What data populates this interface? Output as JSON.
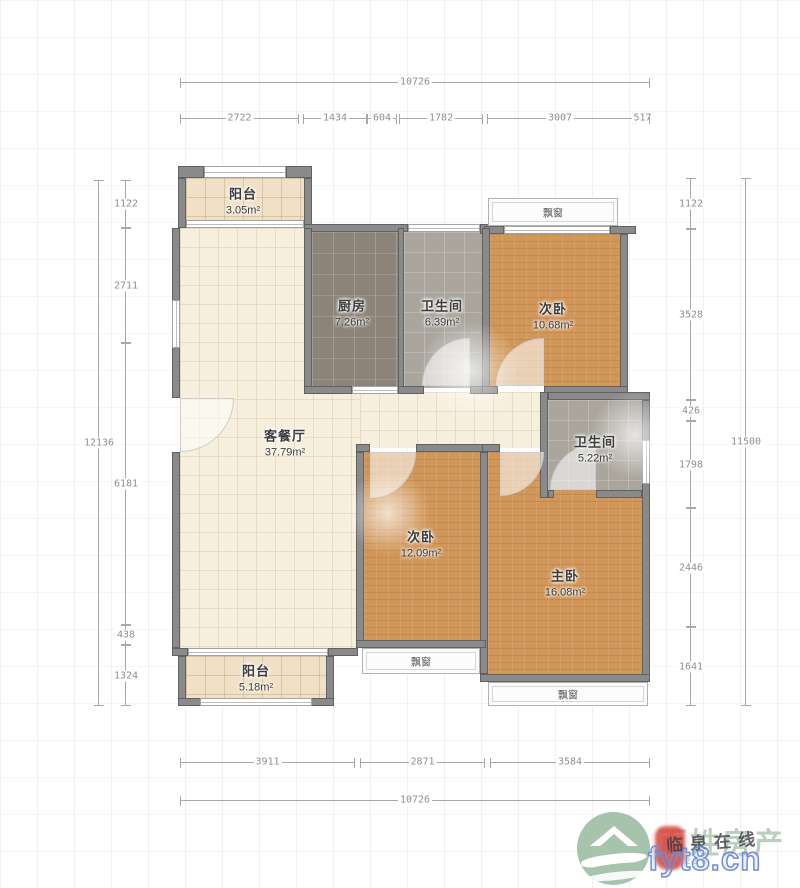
{
  "dims": {
    "top_total": "10726",
    "top_segments": [
      "2722",
      "1434",
      "604",
      "1782",
      "3007",
      "517"
    ],
    "left_total": "12136",
    "left_segments": [
      "1122",
      "2711",
      "6181",
      "438",
      "1324"
    ],
    "right_total": "11500",
    "right_segments": [
      "1122",
      "3528",
      "426",
      "1798",
      "2446",
      "1641"
    ],
    "bottom_total": "10726",
    "bottom_segments": [
      "3911",
      "2871",
      "3584"
    ]
  },
  "rooms": {
    "balcony_top": {
      "name": "阳台",
      "area": "3.05m²"
    },
    "kitchen": {
      "name": "厨房",
      "area": "7.26m²"
    },
    "bath_top": {
      "name": "卫生间",
      "area": "6.39m²"
    },
    "bedroom_top": {
      "name": "次卧",
      "area": "10.68m²"
    },
    "living": {
      "name": "客餐厅",
      "area": "37.79m²"
    },
    "bath_mid": {
      "name": "卫生间",
      "area": "5.22m²"
    },
    "bedroom_mid": {
      "name": "次卧",
      "area": "12.09m²"
    },
    "master": {
      "name": "主卧",
      "area": "16.08m²"
    },
    "balcony_bottom": {
      "name": "阳台",
      "area": "5.18m²"
    },
    "bay_top": {
      "name": "飘窗"
    },
    "bay_bottom_mid": {
      "name": "飘窗"
    },
    "bay_bottom_right": {
      "name": "飘窗"
    }
  },
  "watermark": {
    "brand": "百姓房产",
    "brand_sub": "BA 236",
    "overlay_site": "临泉在线",
    "overlay_url": "fyt8.cn"
  },
  "colors": {
    "wall": "#8a8a8a",
    "wall_edge": "#616161",
    "floor_cream": "#f7efde",
    "floor_balcony": "#f0e1c6",
    "floor_kitchen": "#8d8479",
    "floor_bath": "#aaa69d",
    "floor_wood": "#d1975a",
    "dim_line": "#a8a8a8",
    "dim_text": "#8f8f8f",
    "label_text": "#3c3c3c",
    "brand_green": "#a6c3ac",
    "overlay_blue": "#6c8fd8",
    "seal_red": "#d8453a"
  }
}
